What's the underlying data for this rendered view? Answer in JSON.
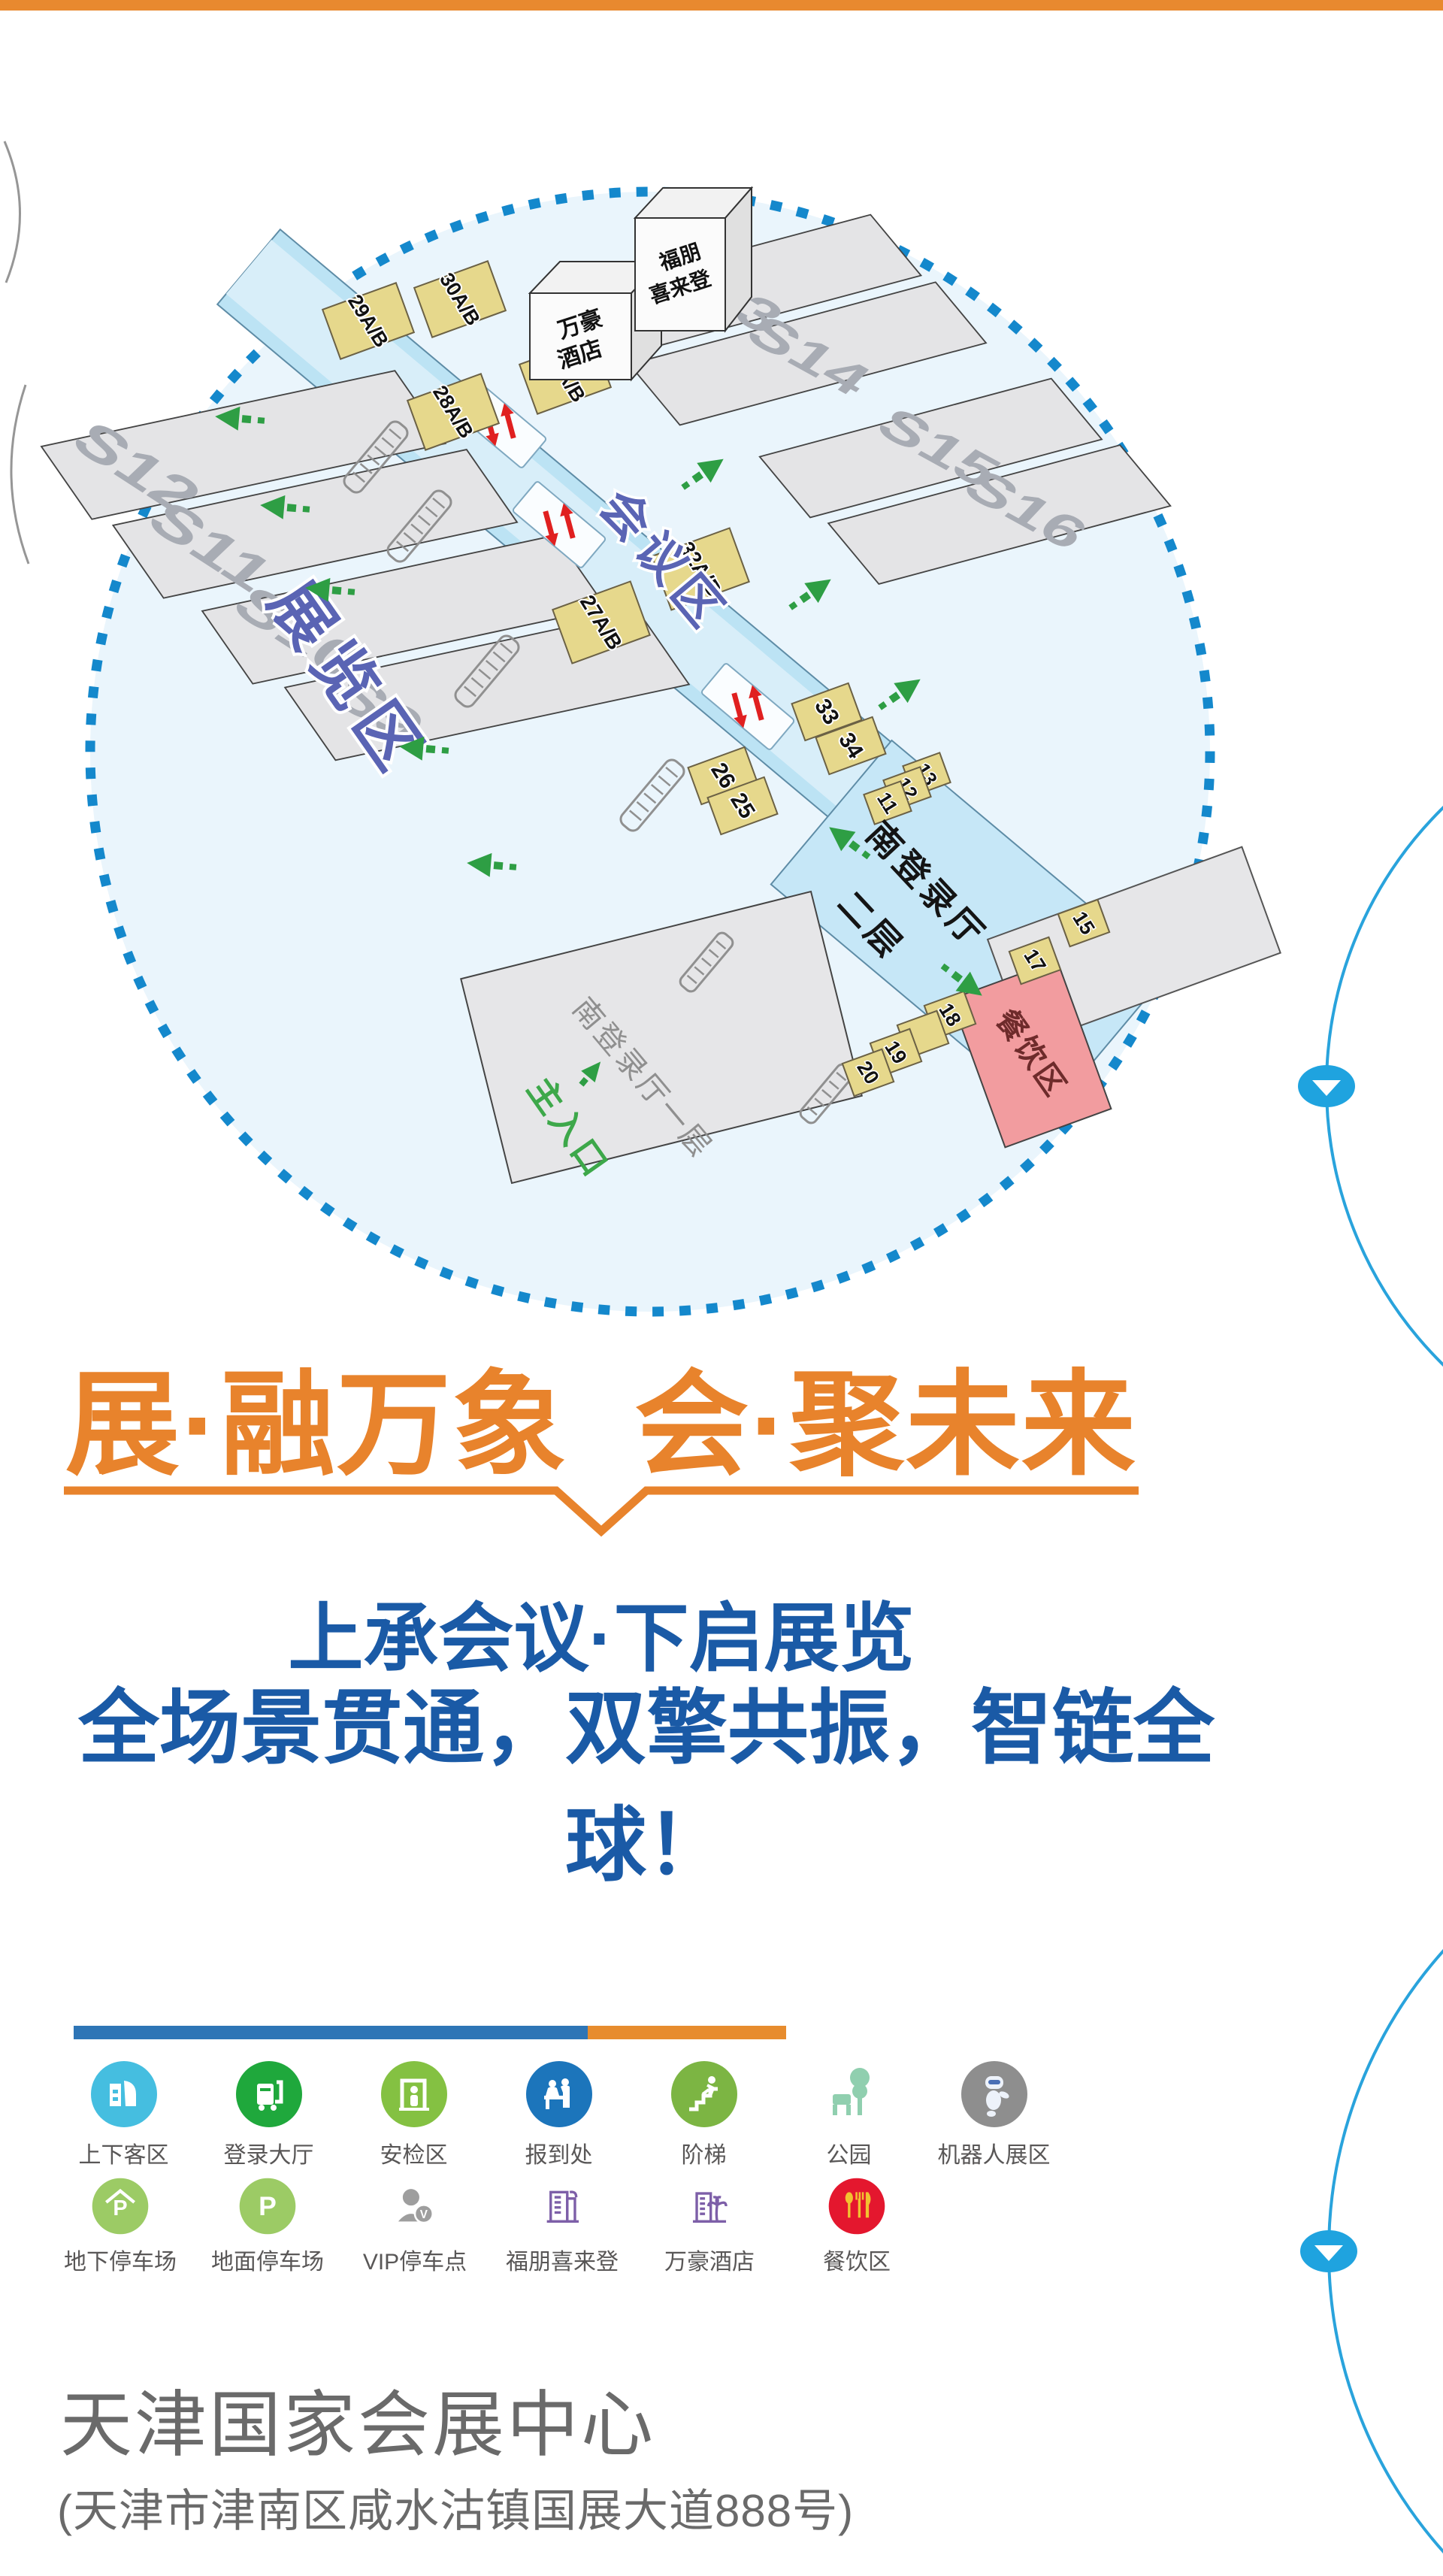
{
  "colors": {
    "top_bar": "#E8892F",
    "title_orange": "#E8832C",
    "headline_blue": "#1A5AA6",
    "legend_bar_blue": "#2E75B6",
    "legend_bar_orange": "#E78C2E",
    "map_fill": "#EAF5FC",
    "map_dot_border": "#1488CC",
    "corridor_blue": "#BCE3F4",
    "arc_blue": "#29A3DC",
    "dining_red": "#F29C9F"
  },
  "map": {
    "halls": [
      "S12",
      "S11",
      "S10",
      "S9",
      "S13",
      "S14",
      "S15",
      "S16"
    ],
    "meeting_rooms": [
      "29A/B",
      "30A/B",
      "28A/B",
      "31A/B",
      "27A/B",
      "32A/B"
    ],
    "rooms_small": [
      "33",
      "34",
      "26",
      "25",
      "13",
      "12",
      "11",
      "15",
      "17",
      "18",
      "19",
      "20"
    ],
    "areas": {
      "exhibition": "展览区",
      "conference": "会议区",
      "south_hall_l2_a": "南登录厅",
      "south_hall_l2_b": "二层",
      "south_hall_l1": "南登录厅一层",
      "main_entrance": "主入口",
      "dining": "餐饮区"
    },
    "hotels": {
      "marriott_1": "万豪",
      "marriott_2": "酒店",
      "sheraton_1": "福朋",
      "sheraton_2": "喜来登"
    }
  },
  "headline": {
    "title": "展·融万象  会·聚未来",
    "line1": "上承会议·下启展览",
    "line2": "全场景贯通，双擎共振，智链全球！"
  },
  "legend": {
    "row1": [
      {
        "label": "上下客区",
        "color": "#45BEE0"
      },
      {
        "label": "登录大厅",
        "color": "#1FA83C"
      },
      {
        "label": "安检区",
        "color": "#84C142"
      },
      {
        "label": "报到处",
        "color": "#1C75BB"
      },
      {
        "label": "阶梯",
        "color": "#7CB543"
      },
      {
        "label": "公园",
        "color": "#90CFAF"
      },
      {
        "label": "机器人展区",
        "color": "#8E8E8E"
      }
    ],
    "row2": [
      {
        "label": "地下停车场",
        "color": "#9CCB65"
      },
      {
        "label": "地面停车场",
        "color": "#9CCB65"
      },
      {
        "label": "VIP停车点",
        "color": "#9E9E9E"
      },
      {
        "label": "福朋喜来登",
        "color": "#7D5FA8"
      },
      {
        "label": "万豪酒店",
        "color": "#7D5FA8"
      },
      {
        "label": "餐饮区",
        "color": "#E4172E"
      }
    ]
  },
  "footer": {
    "venue": "天津国家会展中心",
    "address": "(天津市津南区咸水沽镇国展大道888号)"
  }
}
